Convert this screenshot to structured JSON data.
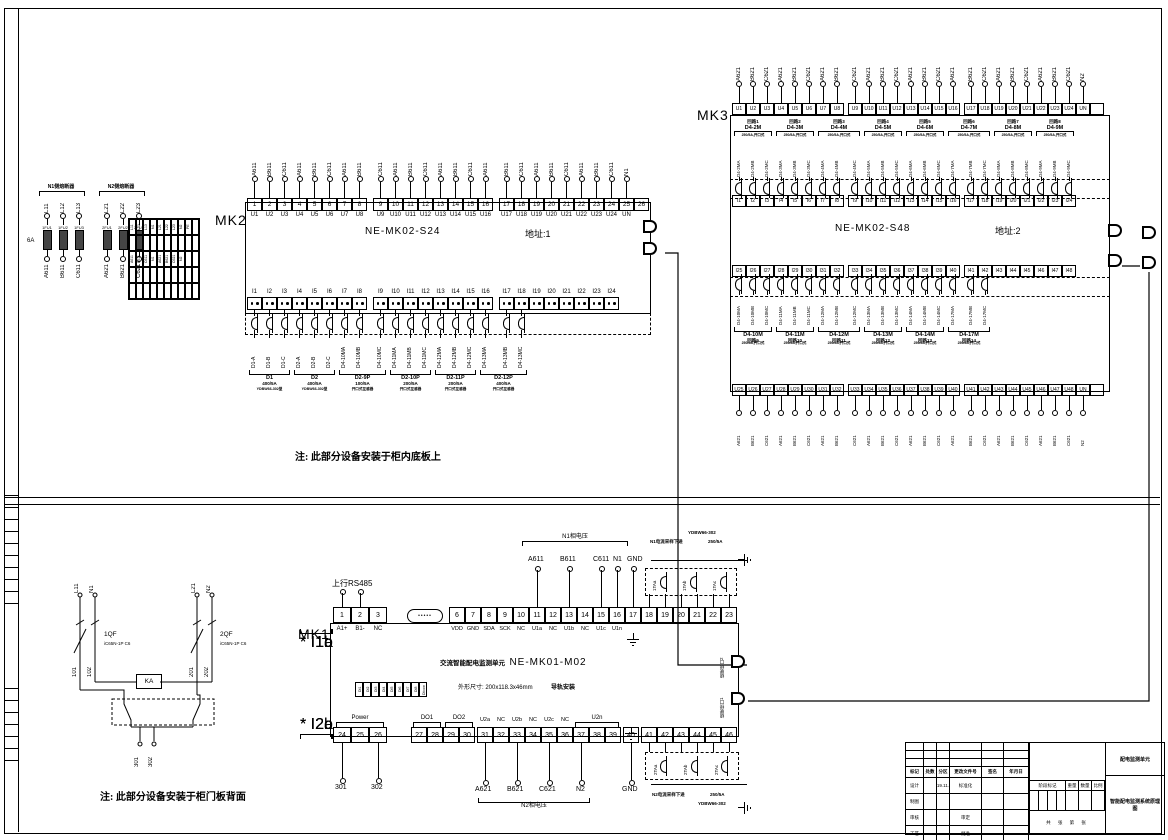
{
  "notes": {
    "top": "注: 此部分设备安装于柜内底板上",
    "bottom": "注: 此部分设备安装于柜门板背面"
  },
  "fuse_panel": {
    "n1_title": "N1侧熔断器",
    "n2_title": "N2侧熔断器",
    "rating": "6A",
    "n1": [
      {
        "in": "L11",
        "fu": "1FU1",
        "out": "A611"
      },
      {
        "in": "L12",
        "fu": "1FU2",
        "out": "B611"
      },
      {
        "in": "L13",
        "fu": "1FU3",
        "out": "C611"
      }
    ],
    "n2": [
      {
        "in": "L21",
        "fu": "2FU1",
        "out": "A621"
      },
      {
        "in": "L22",
        "fu": "2FU2",
        "out": "B621"
      },
      {
        "in": "L23",
        "fu": "2FU3",
        "out": "C621"
      }
    ],
    "grid": [
      "L11",
      "L12",
      "L13",
      "N1",
      "L21",
      "L22",
      "L23",
      "N2",
      "PE",
      "",
      "",
      "",
      "",
      "",
      "",
      "",
      "",
      "",
      "",
      "",
      "A611",
      "B611",
      "C611",
      "N1",
      "A621",
      "B621",
      "C621",
      "N2",
      "",
      "",
      "",
      "",
      "",
      "",
      "",
      "",
      "",
      "",
      "",
      "",
      "",
      "",
      "",
      "",
      "",
      "",
      "",
      "",
      "",
      ""
    ]
  },
  "mk2": {
    "name": "MK2",
    "model": "NE-MK02-S24",
    "address": "地址:1",
    "top": [
      {
        "w": "A611",
        "n": "1",
        "u": "U1"
      },
      {
        "w": "B611",
        "n": "2",
        "u": "U2"
      },
      {
        "w": "C611",
        "n": "3",
        "u": "U3"
      },
      {
        "w": "A611",
        "n": "4",
        "u": "U4"
      },
      {
        "w": "B611",
        "n": "5",
        "u": "U5"
      },
      {
        "w": "C611",
        "n": "6",
        "u": "U6"
      },
      {
        "w": "A611",
        "n": "7",
        "u": "U7"
      },
      {
        "w": "B611",
        "n": "8",
        "u": "U8"
      },
      {
        "w": "C611",
        "n": "9",
        "u": "U9"
      },
      {
        "w": "A611",
        "n": "10",
        "u": "U10"
      },
      {
        "w": "B611",
        "n": "11",
        "u": "U11"
      },
      {
        "w": "C611",
        "n": "12",
        "u": "U12"
      },
      {
        "w": "A611",
        "n": "13",
        "u": "U13"
      },
      {
        "w": "B611",
        "n": "14",
        "u": "U14"
      },
      {
        "w": "C611",
        "n": "15",
        "u": "U15"
      },
      {
        "w": "A611",
        "n": "16",
        "u": "U16"
      },
      {
        "w": "B611",
        "n": "17",
        "u": "U17"
      },
      {
        "w": "C611",
        "n": "18",
        "u": "U18"
      },
      {
        "w": "A611",
        "n": "19",
        "u": "U19"
      },
      {
        "w": "B611",
        "n": "20",
        "u": "U20"
      },
      {
        "w": "C611",
        "n": "21",
        "u": "U21"
      },
      {
        "w": "A611",
        "n": "22",
        "u": "U22"
      },
      {
        "w": "B611",
        "n": "23",
        "u": "U23"
      },
      {
        "w": "C611",
        "n": "24",
        "u": "U24"
      },
      {
        "w": "N1",
        "n": "25",
        "u": "UN"
      },
      {
        "w": "",
        "n": "26",
        "u": ""
      }
    ],
    "bottom": [
      {
        "i": "I1",
        "d": "D1-A"
      },
      {
        "i": "I2",
        "d": "D1-B"
      },
      {
        "i": "I3",
        "d": "D1-C"
      },
      {
        "i": "I4",
        "d": "D2-A"
      },
      {
        "i": "I5",
        "d": "D2-B"
      },
      {
        "i": "I6",
        "d": "D2-C"
      },
      {
        "i": "I7",
        "d": "D4-10MA"
      },
      {
        "i": "I8",
        "d": "D4-10MB"
      },
      {
        "i": "I9",
        "d": "D4-10MC"
      },
      {
        "i": "I10",
        "d": "D4-11MA"
      },
      {
        "i": "I11",
        "d": "D4-11MB"
      },
      {
        "i": "I12",
        "d": "D4-11MC"
      },
      {
        "i": "I13",
        "d": "D4-12MA"
      },
      {
        "i": "I14",
        "d": "D4-12MB"
      },
      {
        "i": "I15",
        "d": "D4-12MC"
      },
      {
        "i": "I16",
        "d": "D4-13MA"
      },
      {
        "i": "I17",
        "d": "D4-13MB"
      },
      {
        "i": "I18",
        "d": "D4-13MC"
      },
      {
        "i": "I19",
        "d": ""
      },
      {
        "i": "I20",
        "d": ""
      },
      {
        "i": "I21",
        "d": ""
      },
      {
        "i": "I22",
        "d": ""
      },
      {
        "i": "I23",
        "d": ""
      },
      {
        "i": "I24",
        "d": ""
      }
    ],
    "groups": [
      {
        "label": "D1",
        "l1": "400/5A",
        "l2": "YDBW66-302型"
      },
      {
        "label": "D2",
        "l1": "400/5A",
        "l2": "YDBW66-302型"
      },
      {
        "label": "D2-9P",
        "l1": "100/5A",
        "l2": "开口式互感器"
      },
      {
        "label": "D2-10P",
        "l1": "200/5A",
        "l2": "开口式互感器"
      },
      {
        "label": "D2-11P",
        "l1": "200/5A",
        "l2": "开口式互感器"
      },
      {
        "label": "D2-12P",
        "l1": "400/5A",
        "l2": "开口式互感器"
      }
    ]
  },
  "mk3": {
    "name": "MK3",
    "model": "NE-MK02-S48",
    "address": "地址:2",
    "top": [
      {
        "w": "A621",
        "u": "U1"
      },
      {
        "w": "B621",
        "u": "U2"
      },
      {
        "w": "C621",
        "u": "U3"
      },
      {
        "w": "A621",
        "u": "U4"
      },
      {
        "w": "B621",
        "u": "U5"
      },
      {
        "w": "C621",
        "u": "U6"
      },
      {
        "w": "A621",
        "u": "U7"
      },
      {
        "w": "B621",
        "u": "U8"
      },
      {
        "w": "C621",
        "u": "U9"
      },
      {
        "w": "A621",
        "u": "U10"
      },
      {
        "w": "B621",
        "u": "U11"
      },
      {
        "w": "C621",
        "u": "U12"
      },
      {
        "w": "A621",
        "u": "U13"
      },
      {
        "w": "B621",
        "u": "U14"
      },
      {
        "w": "C621",
        "u": "U15"
      },
      {
        "w": "A621",
        "u": "U16"
      },
      {
        "w": "B621",
        "u": "U17"
      },
      {
        "w": "C621",
        "u": "U18"
      },
      {
        "w": "A621",
        "u": "U19"
      },
      {
        "w": "B621",
        "u": "U20"
      },
      {
        "w": "C621",
        "u": "U21"
      },
      {
        "w": "A621",
        "u": "U22"
      },
      {
        "w": "B621",
        "u": "U23"
      },
      {
        "w": "C621",
        "u": "U24"
      },
      {
        "w": "N2",
        "u": "UN"
      },
      {
        "w": "",
        "u": ""
      }
    ],
    "upper": [
      {
        "i": "I1",
        "d": "D4-2MA"
      },
      {
        "i": "I2",
        "d": "D4-2MB"
      },
      {
        "i": "I3",
        "d": "D4-2MC"
      },
      {
        "i": "I4",
        "d": "D4-3MA"
      },
      {
        "i": "I5",
        "d": "D4-3MB"
      },
      {
        "i": "I6",
        "d": "D4-3MC"
      },
      {
        "i": "I7",
        "d": "D4-4MA"
      },
      {
        "i": "I8",
        "d": "D4-4MB"
      },
      {
        "i": "I9",
        "d": "D4-4MC"
      },
      {
        "i": "I10",
        "d": "D4-5MA"
      },
      {
        "i": "I11",
        "d": "D4-5MB"
      },
      {
        "i": "I12",
        "d": "D4-5MC"
      },
      {
        "i": "I13",
        "d": "D4-6MA"
      },
      {
        "i": "I14",
        "d": "D4-6MB"
      },
      {
        "i": "I15",
        "d": "D4-6MC"
      },
      {
        "i": "I16",
        "d": "D4-7MA"
      },
      {
        "i": "I17",
        "d": "D4-7MB"
      },
      {
        "i": "I18",
        "d": "D4-7MC"
      },
      {
        "i": "I19",
        "d": "D4-8MA"
      },
      {
        "i": "I20",
        "d": "D4-8MB"
      },
      {
        "i": "I21",
        "d": "D4-8MC"
      },
      {
        "i": "I22",
        "d": "D4-9MA"
      },
      {
        "i": "I23",
        "d": "D4-9MB"
      },
      {
        "i": "I24",
        "d": "D4-9MC"
      }
    ],
    "upper_groups": [
      {
        "t": "回路1",
        "label": "D4-2M",
        "sub": "250/5A,开口式"
      },
      {
        "t": "回路2",
        "label": "D4-3M",
        "sub": "250/5A,开口式"
      },
      {
        "t": "回路3",
        "label": "D4-4M",
        "sub": "250/5A,开口式"
      },
      {
        "t": "回路4",
        "label": "D4-5M",
        "sub": "250/5A,开口式"
      },
      {
        "t": "回路5",
        "label": "D4-6M",
        "sub": "250/5A,开口式"
      },
      {
        "t": "回路6",
        "label": "D4-7M",
        "sub": "250/5A,开口式"
      },
      {
        "t": "回路7",
        "label": "D4-8M",
        "sub": "250/5A,开口式"
      },
      {
        "t": "回路8",
        "label": "D4-9M",
        "sub": "250/5A,开口式"
      }
    ],
    "lower": [
      {
        "i": "I25",
        "d": "D4-10MA"
      },
      {
        "i": "I26",
        "d": "D4-10MB"
      },
      {
        "i": "I27",
        "d": "D4-10MC"
      },
      {
        "i": "I28",
        "d": "D4-11MA"
      },
      {
        "i": "I29",
        "d": "D4-11MB"
      },
      {
        "i": "I30",
        "d": "D4-11MC"
      },
      {
        "i": "I31",
        "d": "D4-12MA"
      },
      {
        "i": "I32",
        "d": "D4-12MB"
      },
      {
        "i": "I33",
        "d": "D4-12MC"
      },
      {
        "i": "I34",
        "d": "D4-13MA"
      },
      {
        "i": "I35",
        "d": "D4-13MB"
      },
      {
        "i": "I36",
        "d": "D4-13MC"
      },
      {
        "i": "I37",
        "d": "D4-14MA"
      },
      {
        "i": "I38",
        "d": "D4-14MB"
      },
      {
        "i": "I39",
        "d": "D4-14MC"
      },
      {
        "i": "I40",
        "d": "D4-17MA"
      },
      {
        "i": "I41",
        "d": "D4-17MB"
      },
      {
        "i": "I42",
        "d": "D4-17MC"
      },
      {
        "i": "I43",
        "d": ""
      },
      {
        "i": "I44",
        "d": ""
      },
      {
        "i": "I45",
        "d": ""
      },
      {
        "i": "I46",
        "d": ""
      },
      {
        "i": "I47",
        "d": ""
      },
      {
        "i": "I48",
        "d": ""
      }
    ],
    "lower_groups": [
      {
        "t": "回路9",
        "label": "D4-10M",
        "sub": "250/5A,开口式"
      },
      {
        "t": "回路10",
        "label": "D4-11M",
        "sub": "250/5A,开口式"
      },
      {
        "t": "回路11",
        "label": "D4-12M",
        "sub": "250/5A,开口式"
      },
      {
        "t": "回路12",
        "label": "D4-13M",
        "sub": "250/5A,开口式"
      },
      {
        "t": "回路13",
        "label": "D4-14M",
        "sub": "250/5A,开口式"
      },
      {
        "t": "回路14",
        "label": "D4-17M",
        "sub": "250/5A,开口式"
      }
    ],
    "bottom": [
      {
        "u": "U25",
        "w": "A621"
      },
      {
        "u": "U26",
        "w": "B621"
      },
      {
        "u": "U27",
        "w": "C621"
      },
      {
        "u": "U28",
        "w": "A621"
      },
      {
        "u": "U29",
        "w": "B621"
      },
      {
        "u": "U30",
        "w": "C621"
      },
      {
        "u": "U31",
        "w": "A621"
      },
      {
        "u": "U32",
        "w": "B621"
      },
      {
        "u": "U33",
        "w": "C621"
      },
      {
        "u": "U34",
        "w": "A621"
      },
      {
        "u": "U35",
        "w": "B621"
      },
      {
        "u": "U36",
        "w": "C621"
      },
      {
        "u": "U37",
        "w": "A621"
      },
      {
        "u": "U38",
        "w": "B621"
      },
      {
        "u": "U39",
        "w": "C621"
      },
      {
        "u": "U40",
        "w": "A621"
      },
      {
        "u": "U41",
        "w": "B621"
      },
      {
        "u": "U42",
        "w": "C621"
      },
      {
        "u": "U43",
        "w": "A621"
      },
      {
        "u": "U44",
        "w": "B621"
      },
      {
        "u": "U45",
        "w": "C621"
      },
      {
        "u": "U46",
        "w": "A621"
      },
      {
        "u": "U47",
        "w": "B621"
      },
      {
        "u": "U48",
        "w": "C621"
      },
      {
        "u": "UN",
        "w": "N2"
      },
      {
        "u": "",
        "w": ""
      }
    ]
  },
  "mk1": {
    "name": "MK1",
    "rs485": "上行RS485",
    "t123": [
      "1",
      "2",
      "3"
    ],
    "l123": [
      "A1+",
      "B1-",
      "NC"
    ],
    "t623": [
      "6",
      "7",
      "8",
      "9",
      "10",
      "11",
      "12",
      "13",
      "14",
      "15",
      "16",
      "17",
      "18",
      "19",
      "20",
      "21",
      "22",
      "23"
    ],
    "l623": [
      "VDD",
      "GND",
      "SDA",
      "SCK",
      "NC",
      "U1a",
      "NC",
      "U1b",
      "NC",
      "U1c",
      "U1n"
    ],
    "wa": "A611",
    "wb": "B611",
    "wc": "C611",
    "wn": "N1",
    "wgnd": "GND",
    "v1_bracket": "N1相电压",
    "ct1": {
      "cts": [
        "1TAa",
        "1TAb",
        "1TAc"
      ],
      "line1": "N1电流采样下进",
      "rating": "250/5A",
      "model": "YDBW66-302"
    },
    "i1_labels": [
      "I1a",
      "I1b",
      "I1c"
    ],
    "title_prefix": "交流智能配电监测单元",
    "model": "NE-MK01-M02",
    "dims": "外形尺寸: 200x118.3x46mm",
    "mount": "导轨安装",
    "di": [
      "DI1",
      "DI2",
      "DI3",
      "DI4",
      "DI5",
      "DI6",
      "DI7",
      "DI8",
      "DIcom"
    ],
    "ports": [
      "级联接口2",
      "级联接口1"
    ],
    "b2426": [
      "24",
      "25",
      "26"
    ],
    "b2730": [
      "27",
      "28",
      "29",
      "30"
    ],
    "b3139": [
      "31",
      "32",
      "33",
      "34",
      "35",
      "36",
      "37",
      "38",
      "39"
    ],
    "b40": "40",
    "b4146": [
      "41",
      "42",
      "43",
      "44",
      "45",
      "46"
    ],
    "power": "Power",
    "do1": "DO1",
    "do2": "DO2",
    "u2_labels": [
      "U2a",
      "NC",
      "U2b",
      "NC",
      "U2c",
      "NC"
    ],
    "u2n": "U2n",
    "i2_labels": [
      "I2a",
      "I2b",
      "I2c"
    ],
    "w301": "301",
    "w302": "302",
    "wa2": "A621",
    "wb2": "B621",
    "wc2": "C621",
    "wn2": "N2",
    "wgnd2": "GND",
    "v2_bracket": "N2相电压",
    "ct2": {
      "cts": [
        "2TAa",
        "2TAb",
        "2TAc"
      ],
      "line1": "N2电流采样下进",
      "rating": "250/5A",
      "model": "YDBW66-302"
    }
  },
  "door": {
    "l11": "L11",
    "n1": "N1",
    "l21": "L21",
    "n2": "N2",
    "qf1": "1QF",
    "qf1m": "iC65N-1P C6",
    "qf2": "2QF",
    "qf2m": "iC65N-1P C6",
    "w101": "101",
    "w102": "102",
    "w201": "201",
    "w202": "202",
    "ka": "KA",
    "o301": "301",
    "o302": "302"
  },
  "titleblock": {
    "head": [
      "标记",
      "处数",
      "分区",
      "更改文件号",
      "签名",
      "年月日"
    ],
    "rev": [
      "",
      "",
      "",
      "",
      "",
      "",
      "",
      "",
      "",
      "",
      "",
      "",
      "",
      "",
      "",
      "",
      "",
      ""
    ],
    "cells": [
      "设计",
      "",
      "2019.11.04",
      "标准化",
      "",
      "",
      "制图",
      "",
      "",
      "",
      "",
      "",
      "审核",
      "",
      "",
      "审定",
      "",
      "",
      "工艺",
      "",
      "",
      "批准",
      "",
      ""
    ],
    "stage": "阶段标记",
    "w": "重量",
    "q": "数量",
    "s": "比例",
    "sheet": "共 张 第 张",
    "title_top": "配电监测单元",
    "title_bottom": "智能配电监测系统原理图"
  }
}
